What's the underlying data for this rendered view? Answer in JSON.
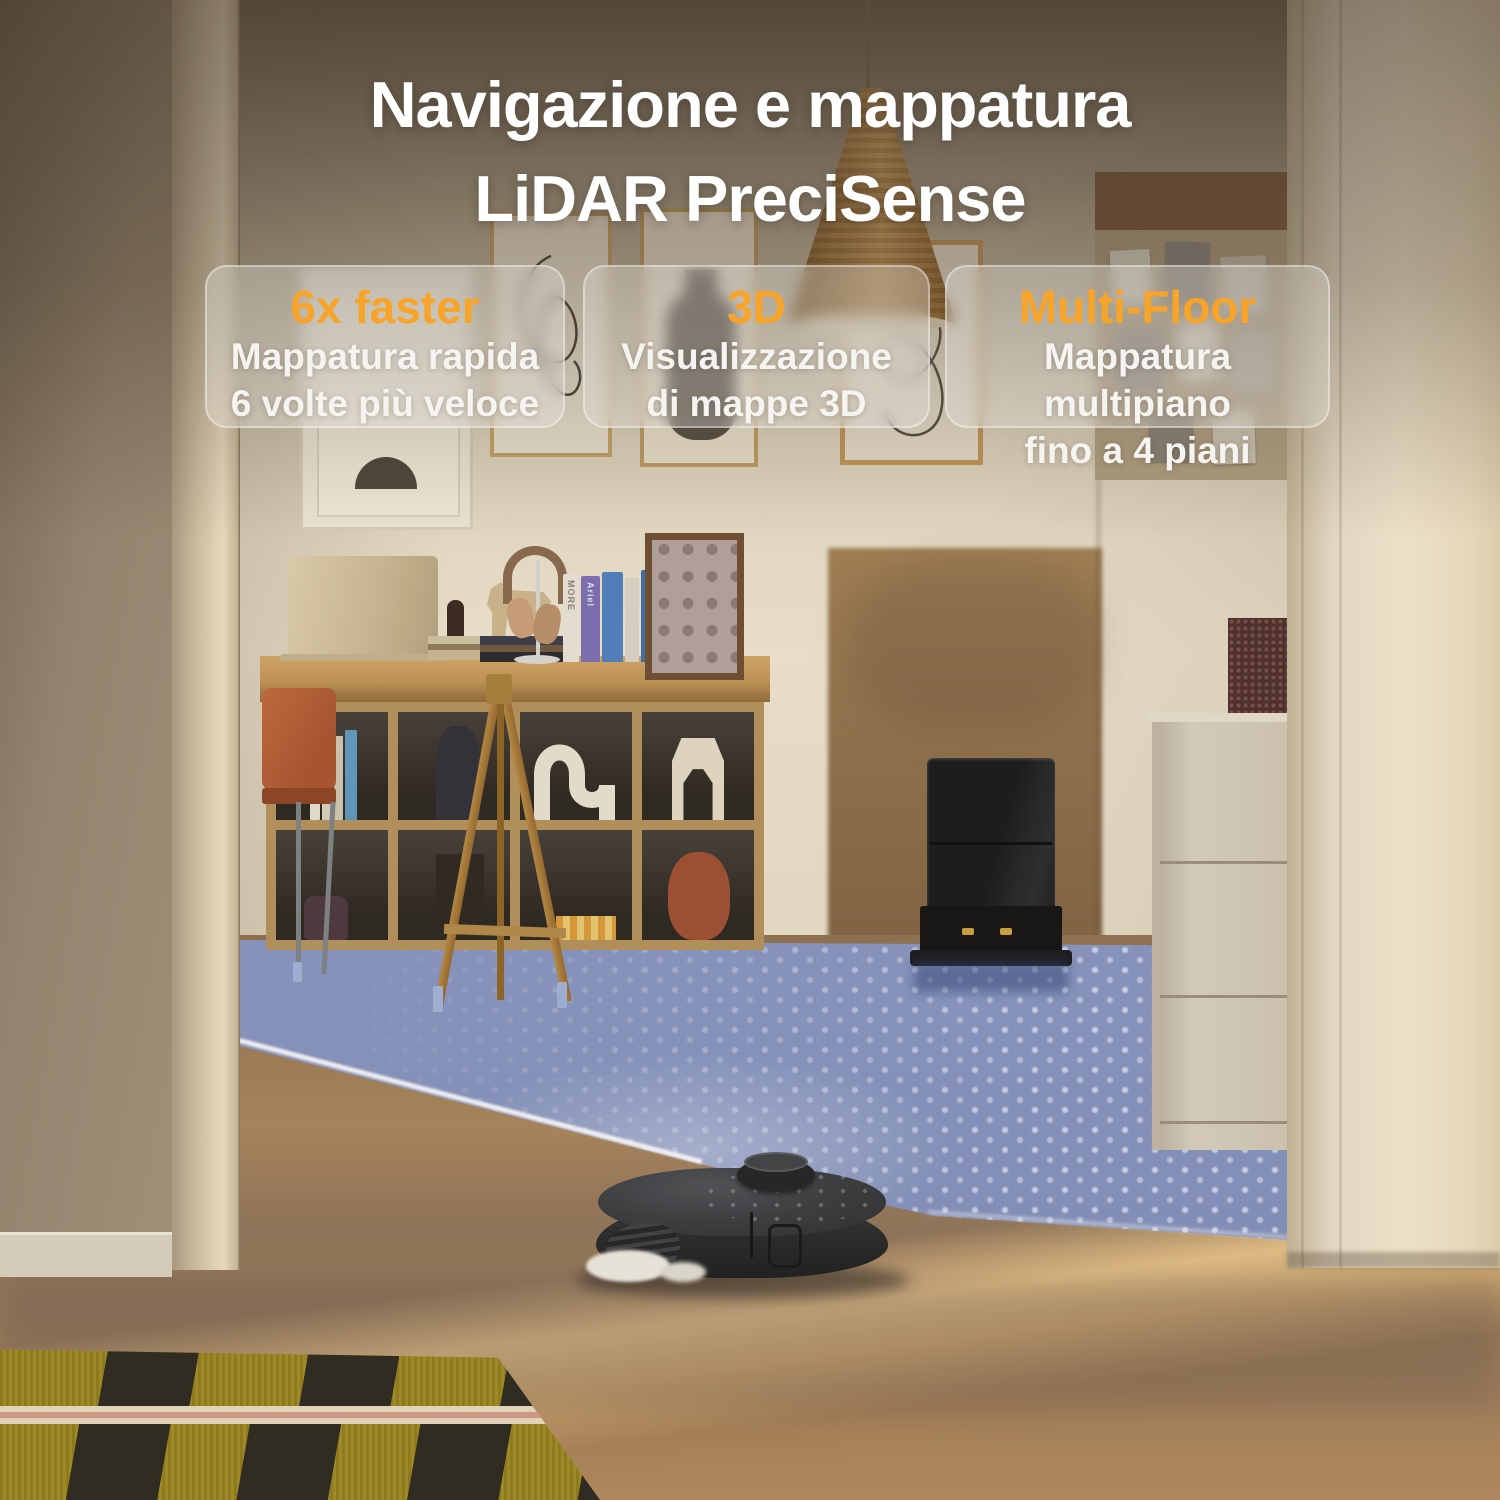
{
  "page": {
    "title": {
      "line1": "Navigazione e mappatura",
      "line2": "LiDAR PreciSense"
    }
  },
  "cards": [
    {
      "headline": "6x faster",
      "line1": "Mappatura rapida",
      "line2": "6 volte più veloce"
    },
    {
      "headline": "3D",
      "line1": "Visualizzazione",
      "line2": "di mappe 3D"
    },
    {
      "headline": "Multi-Floor",
      "line1": "Mappatura multipiano",
      "line2": "fino a 4 piani"
    }
  ],
  "scene": {
    "book_spines": {
      "book1": "MORE",
      "book2": "Ariel"
    }
  },
  "colors": {
    "accent_orange": "#F7A428",
    "lidar_blue": "#8CA0CC",
    "text_white": "#FFFFFF"
  }
}
